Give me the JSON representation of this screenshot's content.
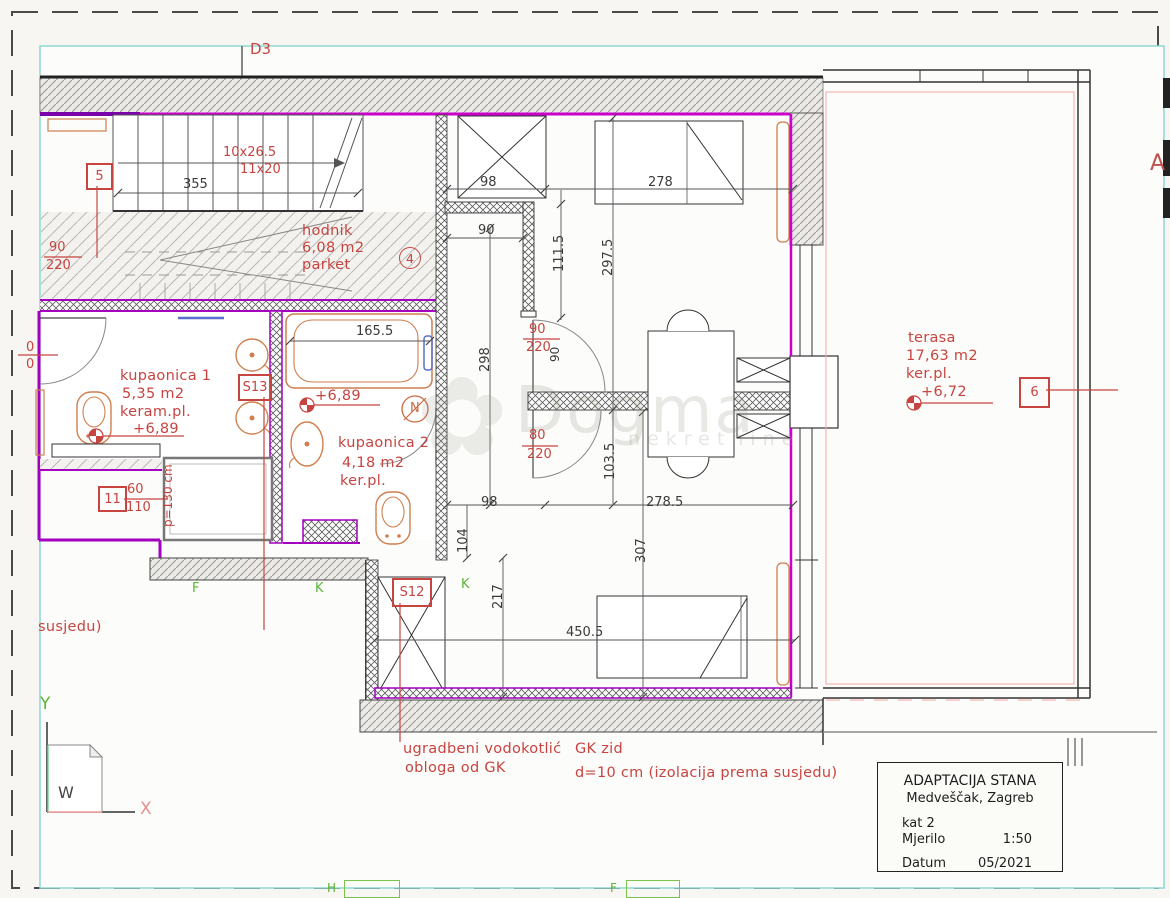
{
  "drawing": {
    "door_label": "D3",
    "stairs": {
      "run_label": "10x26.5",
      "riser_label": "11x20"
    },
    "watermark": {
      "text": "Dogma",
      "subtext": "nekretnine",
      "flower_icon": "✿"
    },
    "letters": {
      "a": "A",
      "f": "F",
      "k_left": "K",
      "k_right": "K",
      "h_bottom": "H",
      "f_bottom": "F"
    },
    "axes": {
      "x_label": "X",
      "y_label": "Y",
      "w_label": "W"
    },
    "markers": {
      "box5": "5",
      "box6": "6",
      "box11": "11",
      "box_s12": "S12",
      "box_s13": "S13",
      "circle4": "4",
      "circle_n": "N"
    }
  },
  "rooms": {
    "hodnik": {
      "name": "hodnik",
      "area": "6,08 m2",
      "finish": "parket"
    },
    "kupaonica1": {
      "name": "kupaonica 1",
      "area": "5,35 m2",
      "finish": "keram.pl.",
      "level": "+6,89"
    },
    "kupaonica2": {
      "name": "kupaonica 2",
      "area": "4,18 m2",
      "finish": "ker.pl.",
      "level": "+6,89"
    },
    "terasa": {
      "name": "terasa",
      "area": "17,63 m2",
      "finish": "ker.pl.",
      "level": "+6,72"
    }
  },
  "dims": {
    "d355": "355",
    "d98_top": "98",
    "d278": "278",
    "d90_top": "90",
    "d111_5": "111.5",
    "d297_5": "297.5",
    "d298": "298",
    "d165_5": "165.5",
    "d90_door": "90",
    "d103_5": "103.5",
    "d98_mid": "98",
    "d278_5": "278.5",
    "d104": "104",
    "d307": "307",
    "d217": "217",
    "d450_5": "450.5",
    "fr_left_num": "90",
    "fr_left_den": "220",
    "fr_door1_num": "90",
    "fr_door1_den": "220",
    "fr_door2_num": "80",
    "fr_door2_den": "220",
    "fr_box11_num": "60",
    "fr_box11_den": "110",
    "fr_partial_num": "0",
    "fr_partial_den": "0",
    "p130": "p=130 cm"
  },
  "notes": {
    "cistern_line1": "ugradbeni vodokotlić",
    "cistern_line2": "obloga od GK",
    "gk_line1": "GK zid",
    "gk_line2": "d=10 cm (izolacija prema susjedu)",
    "neighbor": "susjedu)"
  },
  "title_block": {
    "project": "ADAPTACIJA STANA",
    "location": "Medveščak, Zagreb",
    "floor": "kat 2",
    "scale_label": "Mjerilo",
    "scale_value": "1:50",
    "date_label": "Datum",
    "date_value": "05/2021"
  },
  "colors": {
    "wall_magenta": "#c000c8",
    "annotation_red": "#c74440",
    "axis_green": "#5cb437",
    "cyan_border": "#8fd8d2"
  }
}
